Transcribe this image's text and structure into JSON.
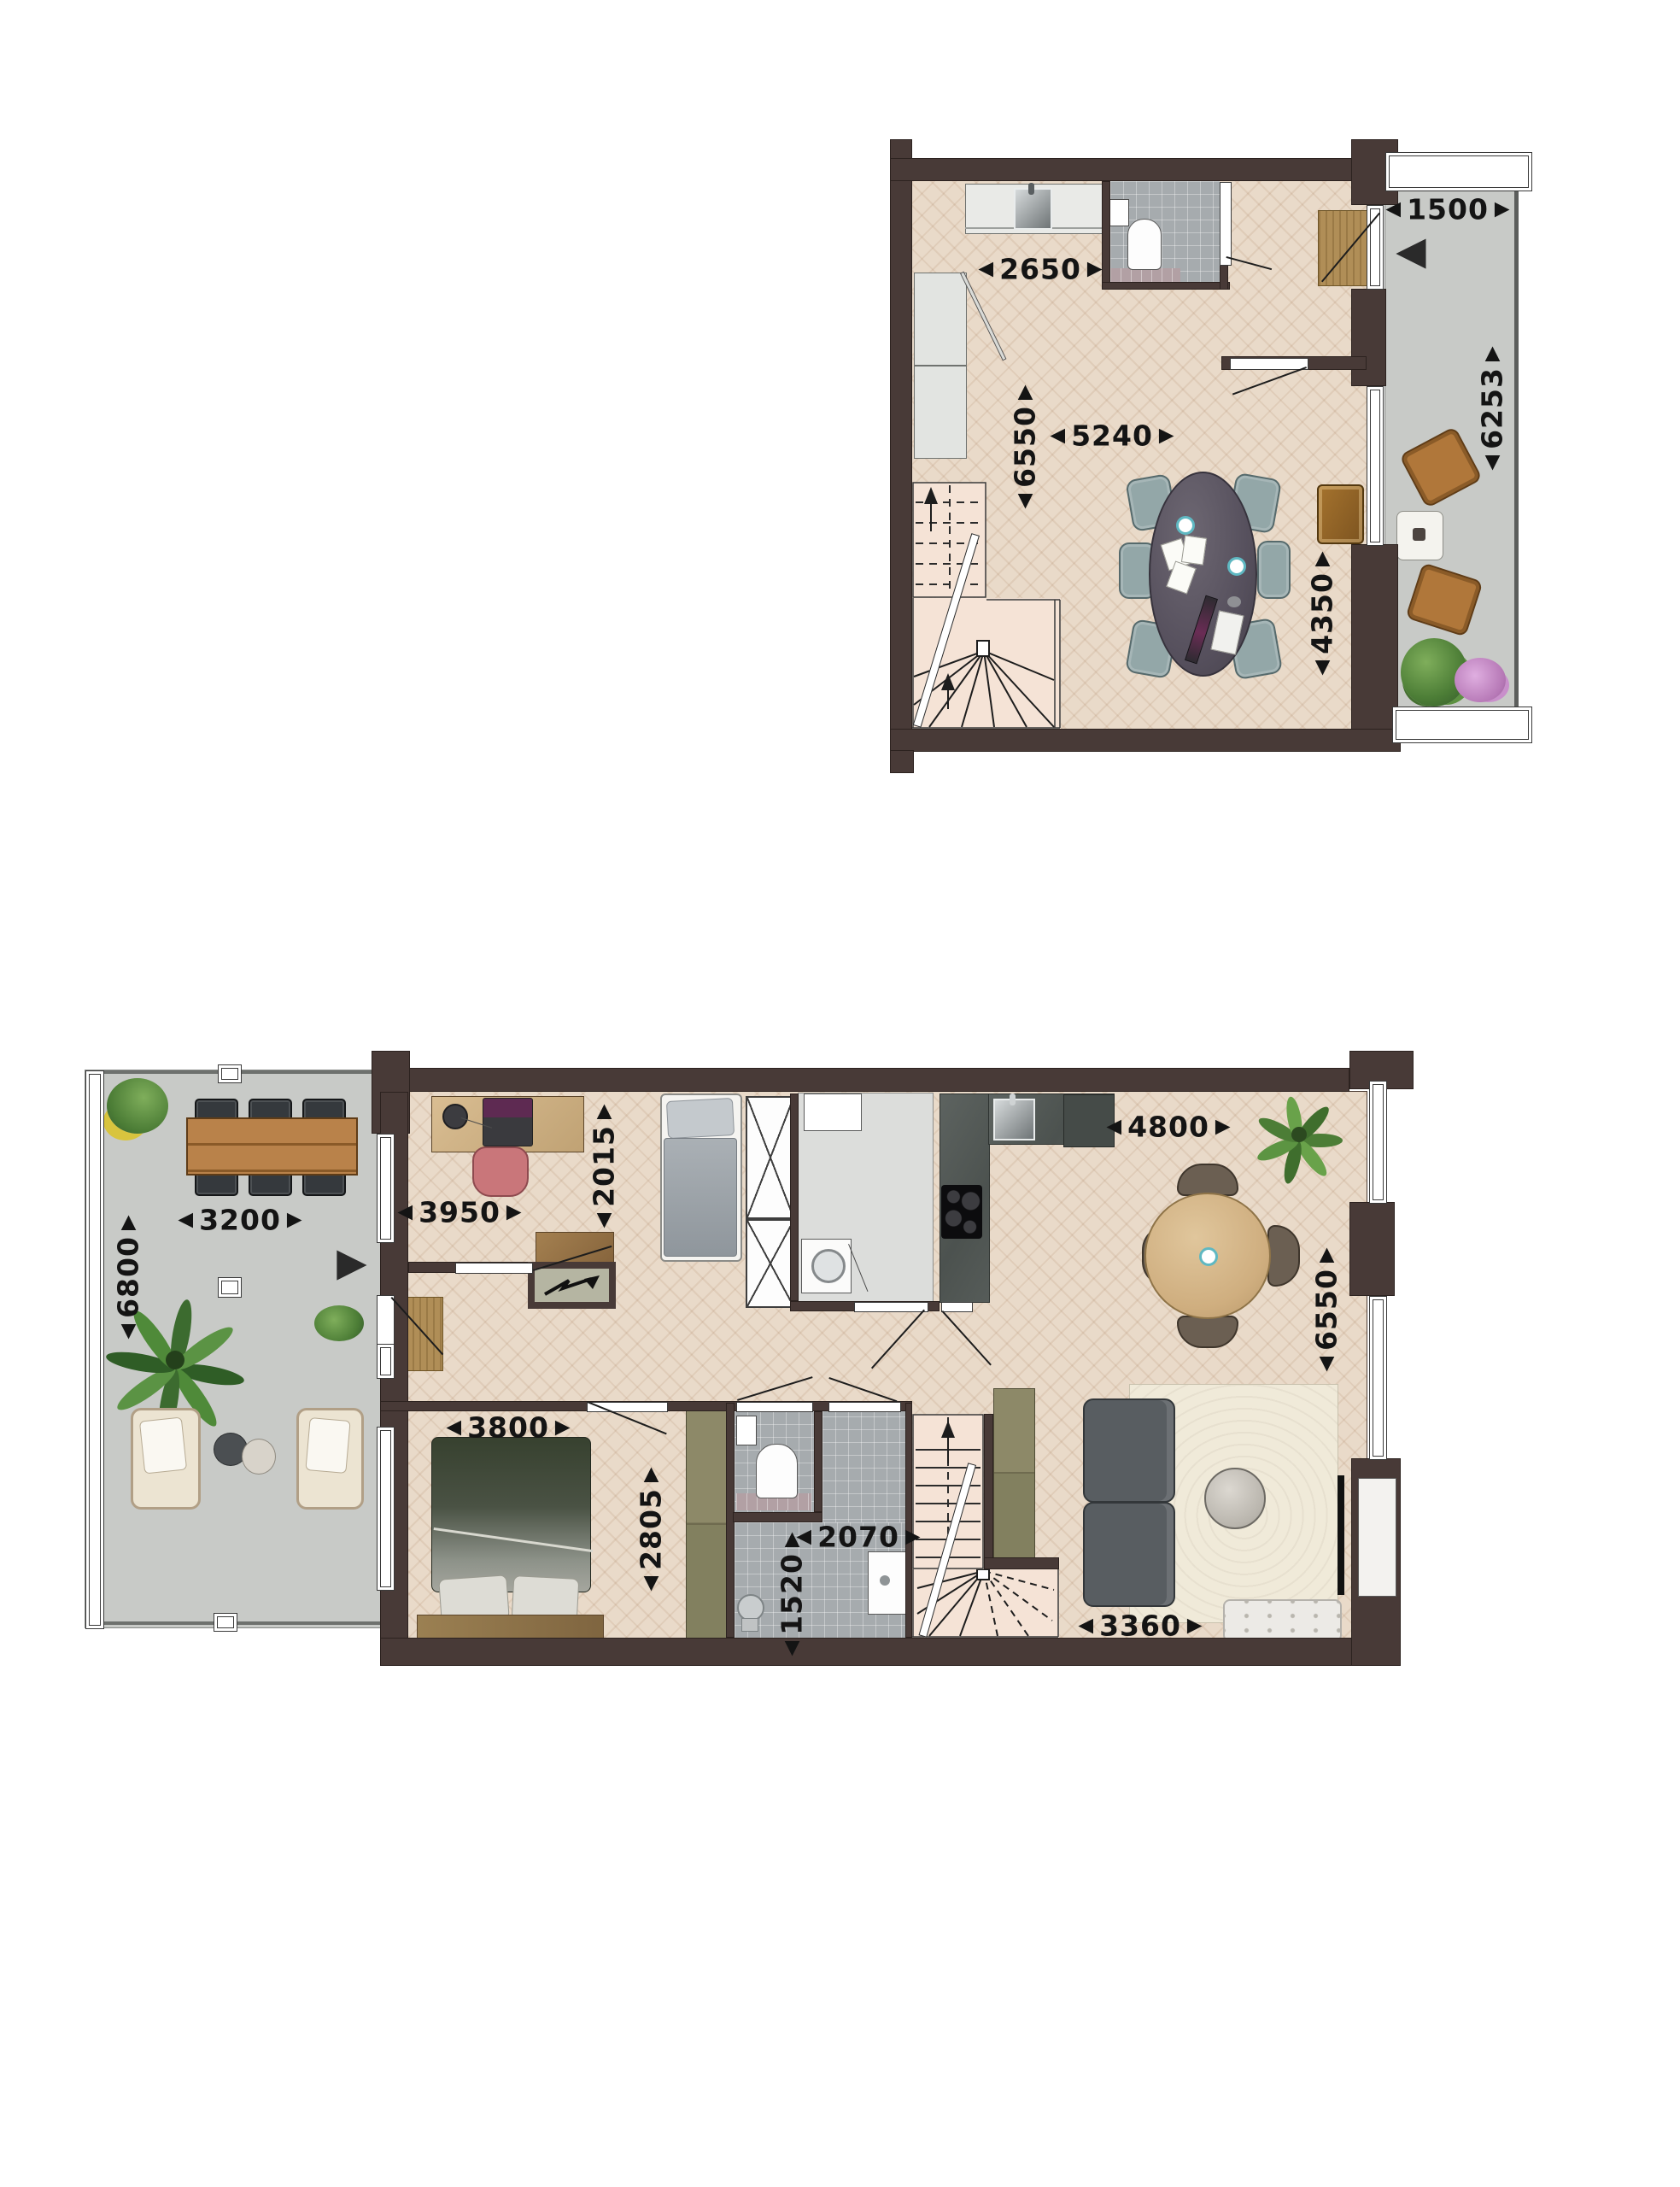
{
  "glyphs": {
    "left": "◀",
    "right": "▶"
  },
  "colors": {
    "wall": "#483a37",
    "wood_floor": "#e9dac9",
    "concrete": "#c8cac7",
    "bathroom_tile": "#a6abae",
    "stair_fill": "#f5e3d6",
    "kitchen_counter": "#575d5a",
    "accent_teal": "#5fb8c2",
    "dimension_text": "#141414"
  },
  "upper_plan": {
    "dims": {
      "kitchen_width": "2650",
      "living_width": "5240",
      "depth_left": "6550",
      "depth_right": "4350",
      "balcony_width": "1500",
      "balcony_depth": "6253"
    }
  },
  "lower_plan": {
    "dims": {
      "office_width": "3950",
      "office_depth": "2015",
      "kitchen_width": "4800",
      "living_depth": "6550",
      "terrace_width": "3200",
      "terrace_depth": "6800",
      "bedroom_width": "3800",
      "bedroom_depth": "2805",
      "bath_width": "2070",
      "bath_depth": "1520",
      "living_width": "3360"
    }
  }
}
